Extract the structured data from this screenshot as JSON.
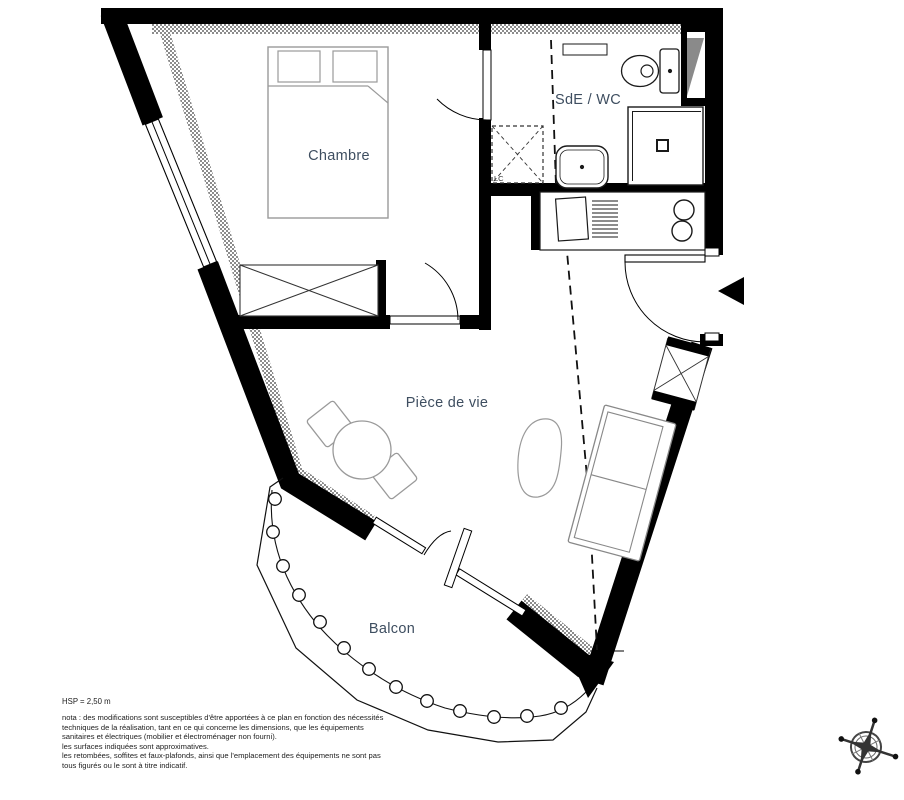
{
  "rooms": {
    "chambre": {
      "label": "Chambre"
    },
    "sde_wc": {
      "label": "SdE / WC"
    },
    "piece_de_vie": {
      "label": "Pièce de vie"
    },
    "balcon": {
      "label": "Balcon"
    },
    "lc": {
      "label": "LC"
    }
  },
  "notes": {
    "hsp": "HSP = 2,50 m",
    "nota_lines": [
      "nota : des modifications sont susceptibles d'être apportées à ce plan en fonction des nécessités",
      "techniques de la réalisation, tant en ce qui concerne les dimensions, que les équipements",
      "sanitaires et électriques (mobilier et électroménager non fourni).",
      "les surfaces indiquées sont approximatives.",
      "les retombées, soffites et faux-plafonds, ainsi que l'emplacement des équipements ne sont pas",
      "tous figurés ou le sont à titre indicatif."
    ]
  },
  "colors": {
    "wall": "#000000",
    "room_label": "#3e4e60",
    "furniture": "#9a9a9a",
    "fixture": "#1a1a1a",
    "hatch": "#777777",
    "shaft_fill": "#8a8a8a"
  }
}
